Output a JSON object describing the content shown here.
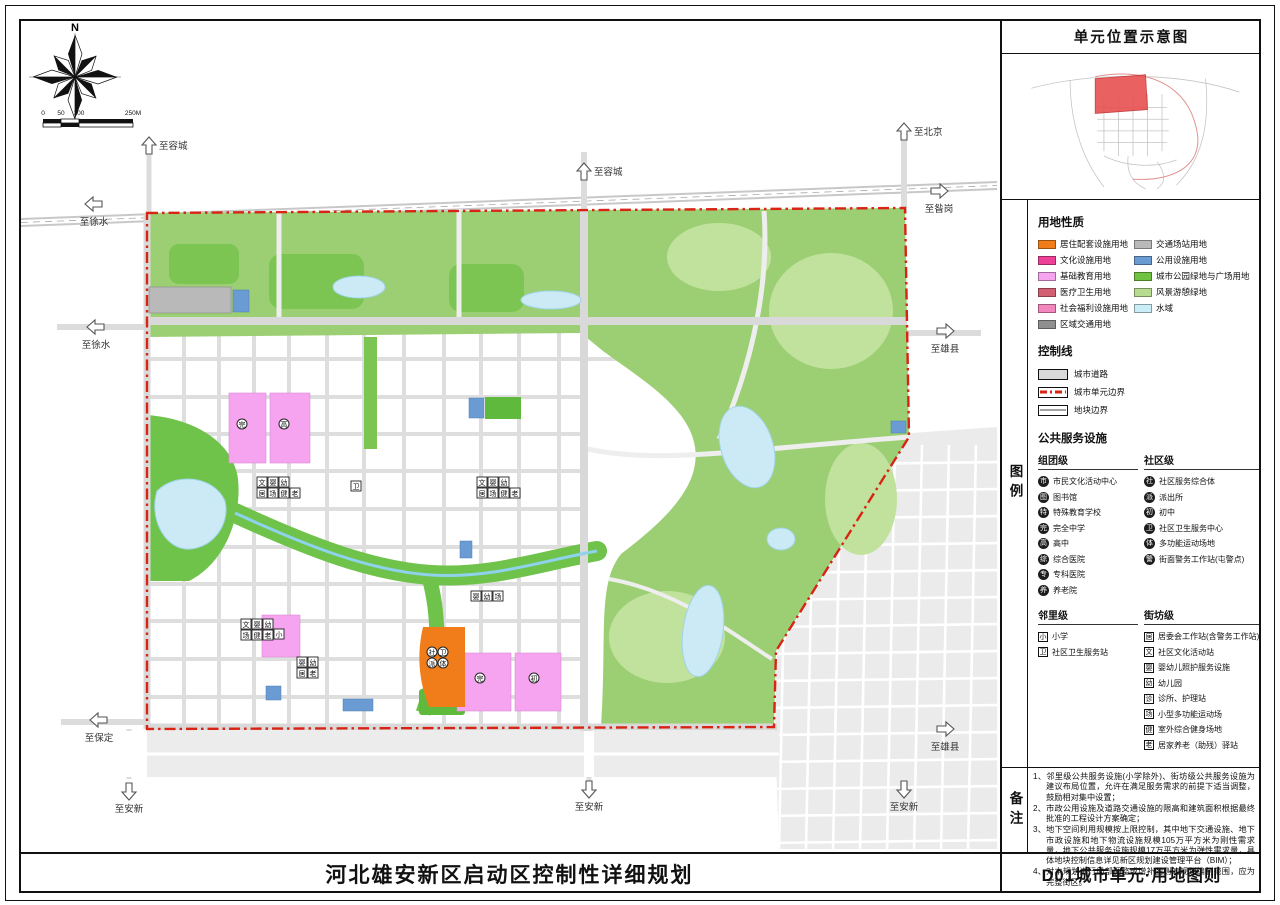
{
  "location_panel": {
    "title": "单元位置示意图",
    "highlight_color": "#e85050"
  },
  "legend": {
    "side_label": "图例",
    "land_use_title": "用地性质",
    "land_use_left": [
      {
        "label": "居住配套设施用地",
        "color": "#F07D1A"
      },
      {
        "label": "文化设施用地",
        "color": "#EE4097"
      },
      {
        "label": "基础教育用地",
        "color": "#F6A3F0"
      },
      {
        "label": "医疗卫生用地",
        "color": "#D26072"
      },
      {
        "label": "社会福利设施用地",
        "color": "#F287BE"
      },
      {
        "label": "区域交通用地",
        "color": "#8F8F8F"
      }
    ],
    "land_use_right": [
      {
        "label": "交通场站用地",
        "color": "#B9B9B9"
      },
      {
        "label": "公用设施用地",
        "color": "#6A9BD3"
      },
      {
        "label": "城市公园绿地与广场用地",
        "color": "#6FC242"
      },
      {
        "label": "风景游憩绿地",
        "color": "#B7DC8F"
      },
      {
        "label": "水域",
        "color": "#CBEDF8"
      }
    ],
    "control_title": "控制线",
    "control_items": [
      {
        "label": "城市道路",
        "style": "road"
      },
      {
        "label": "城市单元边界",
        "style": "unit"
      },
      {
        "label": "地块边界",
        "style": "parcel"
      }
    ],
    "facilities_title": "公共服务设施",
    "facility_groups": [
      {
        "name": "组团级",
        "icon_shape": "circle",
        "items": [
          {
            "icon": "市",
            "label": "市民文化活动中心"
          },
          {
            "icon": "图",
            "label": "图书馆"
          },
          {
            "icon": "特",
            "label": "特殊教育学校"
          },
          {
            "icon": "完",
            "label": "完全中学"
          },
          {
            "icon": "高",
            "label": "高中"
          },
          {
            "icon": "综",
            "label": "综合医院"
          },
          {
            "icon": "专",
            "label": "专科医院"
          },
          {
            "icon": "养",
            "label": "养老院"
          }
        ]
      },
      {
        "name": "社区级",
        "icon_shape": "circle",
        "items": [
          {
            "icon": "社",
            "label": "社区服务综合体"
          },
          {
            "icon": "派",
            "label": "派出所"
          },
          {
            "icon": "初",
            "label": "初中"
          },
          {
            "icon": "卫",
            "label": "社区卫生服务中心"
          },
          {
            "icon": "体",
            "label": "多功能运动场地"
          },
          {
            "icon": "警",
            "label": "街面警务工作站(屯警点)"
          }
        ]
      },
      {
        "name": "邻里级",
        "icon_shape": "square",
        "items": [
          {
            "icon": "小",
            "label": "小学"
          },
          {
            "icon": "卫",
            "label": "社区卫生服务站"
          }
        ]
      },
      {
        "name": "街坊级",
        "icon_shape": "square",
        "items": [
          {
            "icon": "居",
            "label": "居委会工作站(含警务工作站)"
          },
          {
            "icon": "文",
            "label": "社区文化活动站"
          },
          {
            "icon": "婴",
            "label": "婴幼儿照护服务设施"
          },
          {
            "icon": "幼",
            "label": "幼儿园"
          },
          {
            "icon": "诊",
            "label": "诊所、护理站"
          },
          {
            "icon": "场",
            "label": "小型多功能运动场"
          },
          {
            "icon": "健",
            "label": "室外综合健身场地"
          },
          {
            "icon": "老",
            "label": "居家养老（助残）驿站"
          }
        ]
      }
    ]
  },
  "notes": {
    "side_label": "备注",
    "items": [
      "1、邻里级公共服务设施(小学除外)、街坊级公共服务设施为建议布局位置，允许在满足服务需求的前提下适当调整，鼓励相对集中设置；",
      "2、市政公用设施及道路交通设施的限高和建筑面积根据最终批准的工程设计方案确定；",
      "3、地下空间利用规模按上限控制，其中地下交通设施、地下市政设施和地下物流设施规模105万平方米为刚性需求量，地下公共服务设施规模17万平方米为弹性需求量，具体地块控制信息详见新区规划建设管理平台（BIM）；",
      "4、对本规划进行局部调整或增补图则的规划编制范围，应为完整街区。"
    ]
  },
  "title_bar": {
    "main": "河北雄安新区启动区控制性详细规划",
    "sheet": "D01城市单元·用地图则"
  },
  "map": {
    "compass_label": "N",
    "scale_labels": [
      "0",
      "50",
      "100",
      "250M"
    ],
    "unit_boundary_color": "#d92313",
    "arrows": [
      {
        "dir": "up",
        "x": 130,
        "y": 127,
        "label": "至容城"
      },
      {
        "dir": "left",
        "x": 75,
        "y": 185,
        "label": "至徐水"
      },
      {
        "dir": "up",
        "x": 565,
        "y": 153,
        "label": "至容城"
      },
      {
        "dir": "up",
        "x": 885,
        "y": 113,
        "label": "至北京"
      },
      {
        "dir": "right",
        "x": 920,
        "y": 172,
        "label": "至昝岗"
      },
      {
        "dir": "left",
        "x": 77,
        "y": 308,
        "label": "至徐水"
      },
      {
        "dir": "right",
        "x": 926,
        "y": 312,
        "label": "至雄县"
      },
      {
        "dir": "left",
        "x": 80,
        "y": 701,
        "label": "至保定"
      },
      {
        "dir": "right",
        "x": 926,
        "y": 710,
        "label": "至雄县"
      },
      {
        "dir": "down",
        "x": 110,
        "y": 772,
        "label": "至安新"
      },
      {
        "dir": "down",
        "x": 570,
        "y": 770,
        "label": "至安新"
      },
      {
        "dir": "down",
        "x": 885,
        "y": 770,
        "label": "至安新"
      }
    ],
    "clusters": [
      {
        "x": 238,
        "y": 458,
        "shape": "box",
        "rows": [
          [
            "文",
            "婴",
            "幼"
          ],
          [
            "居",
            "场",
            "健",
            "老"
          ]
        ]
      },
      {
        "x": 332,
        "y": 462,
        "shape": "box",
        "rows": [
          [
            "卫"
          ]
        ]
      },
      {
        "x": 458,
        "y": 458,
        "shape": "box",
        "rows": [
          [
            "文",
            "婴",
            "幼"
          ],
          [
            "居",
            "场",
            "健",
            "老"
          ]
        ]
      },
      {
        "x": 452,
        "y": 572,
        "shape": "box",
        "rows": [
          [
            "婴",
            "幼",
            "场"
          ]
        ]
      },
      {
        "x": 222,
        "y": 600,
        "shape": "box",
        "rows": [
          [
            "文",
            "婴",
            "幼"
          ],
          [
            "场",
            "健",
            "老"
          ]
        ]
      },
      {
        "x": 278,
        "y": 638,
        "shape": "box",
        "rows": [
          [
            "婴",
            "幼"
          ],
          [
            "居",
            "老"
          ]
        ]
      },
      {
        "x": 408,
        "y": 628,
        "shape": "circle",
        "rows": [
          [
            "社",
            "卫"
          ],
          [
            "派",
            "体"
          ]
        ]
      },
      {
        "x": 218,
        "y": 400,
        "shape": "circle",
        "rows": [
          [
            "完"
          ]
        ]
      },
      {
        "x": 260,
        "y": 400,
        "shape": "circle",
        "rows": [
          [
            "高"
          ]
        ]
      },
      {
        "x": 255,
        "y": 610,
        "shape": "box",
        "rows": [
          [
            "小"
          ]
        ]
      },
      {
        "x": 456,
        "y": 654,
        "shape": "circle",
        "rows": [
          [
            "完"
          ]
        ]
      },
      {
        "x": 510,
        "y": 654,
        "shape": "circle",
        "rows": [
          [
            "初"
          ]
        ]
      }
    ]
  }
}
